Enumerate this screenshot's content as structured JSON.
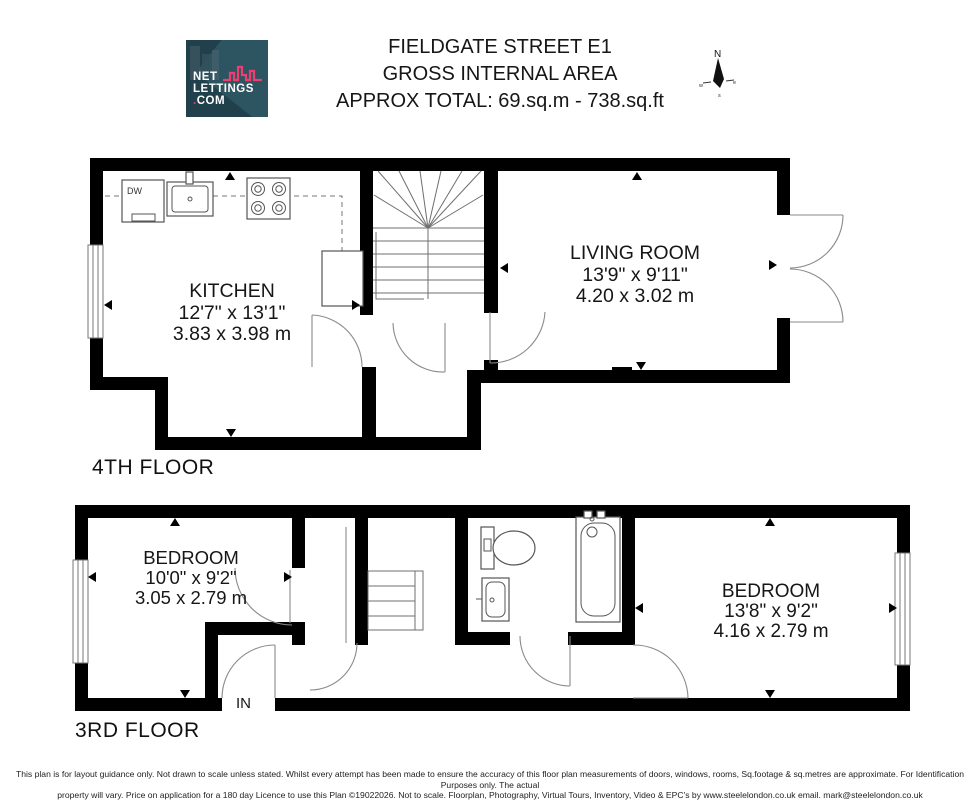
{
  "header": {
    "logo_line1": "NET",
    "logo_line2": "LETTINGS",
    "logo_dot": ".",
    "logo_line3": "COM",
    "title_line1": "FIELDGATE STREET E1",
    "title_line2": "GROSS INTERNAL AREA",
    "title_line3": "APPROX TOTAL: 69.sq.m - 738.sq.ft"
  },
  "compass": {
    "north": "N",
    "west": "w",
    "east": "e",
    "south": "s"
  },
  "floors": [
    {
      "label": "4TH FLOOR",
      "rooms": [
        {
          "name": "KITCHEN",
          "imperial": "12'7\" x 13'1\"",
          "metric": "3.83 x 3.98 m"
        },
        {
          "name": "LIVING ROOM",
          "imperial": "13'9\" x 9'11\"",
          "metric": "4.20 x 3.02 m"
        }
      ]
    },
    {
      "label": "3RD FLOOR",
      "rooms": [
        {
          "name": "BEDROOM",
          "imperial": "10'0\" x 9'2\"",
          "metric": "3.05 x 2.79 m"
        },
        {
          "name": "BEDROOM",
          "imperial": "13'8\" x 9'2\"",
          "metric": "4.16 x 2.79 m"
        }
      ]
    }
  ],
  "annotations": {
    "dishwasher": "DW",
    "entrance": "IN"
  },
  "footer": {
    "line1": "This plan is for layout guidance only. Not drawn to scale unless stated. Whilst every attempt has been made to ensure the accuracy of this floor plan measurements of doors, windows, rooms, Sq.footage & sq.metres are approximate. For Identification Purposes only. The actual",
    "line2": "property will vary. Price on application for a 180 day Licence to use this Plan ©19022026. Not to scale. Floorplan, Photography, Virtual Tours, Inventory, Video & EPC's by www.steelelondon.co.uk  email. mark@steelelondon.co.uk"
  },
  "colors": {
    "wall": "#000000",
    "accent_pink": "#ee3d6e",
    "logo_bg": "#20404b"
  }
}
